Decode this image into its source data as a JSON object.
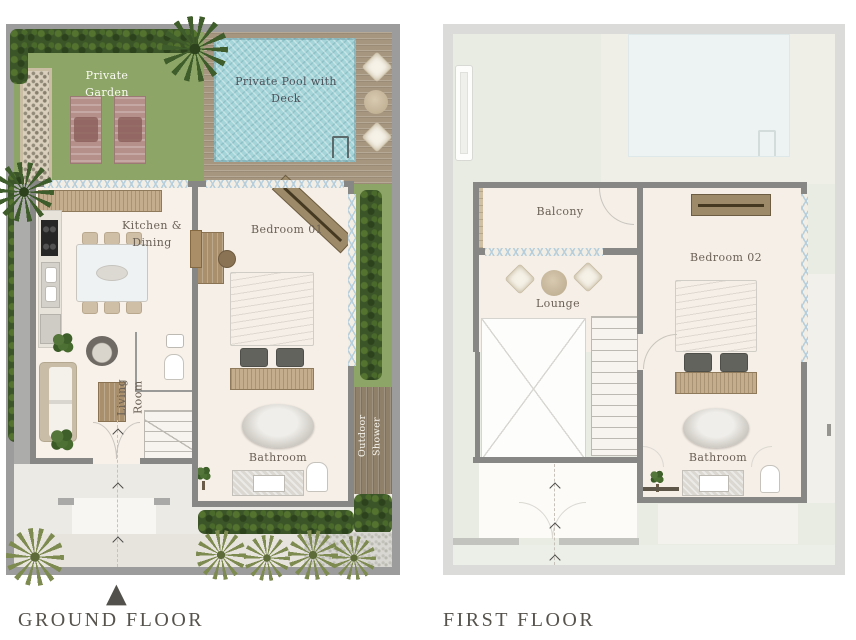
{
  "ground_floor": {
    "title": "GROUND FLOOR",
    "labels": {
      "private_garden": "Private Garden",
      "private_pool": "Private Pool with Deck",
      "kitchen_dining": "Kitchen & Dining",
      "bedroom_01": "Bedroom 01",
      "living_room": "Living Room",
      "bathroom": "Bathroom",
      "outdoor_shower": "Outdoor Shower"
    }
  },
  "first_floor": {
    "title": "FIRST FLOOR",
    "labels": {
      "balcony": "Balcony",
      "lounge": "Lounge",
      "bedroom_02": "Bedroom 02",
      "bathroom": "Bathroom"
    }
  },
  "icons": {
    "entrance_marker": "▲"
  },
  "colors": {
    "garden_green": "#8da667",
    "pool_blue": "#a5d5d9",
    "deck_wood": "#a6967f",
    "interior_cream": "#f6efe7",
    "wall_gray": "#878785",
    "hedge_green": "#3c5528",
    "ground_frame_gray": "#9c9c9c",
    "first_frame_gray": "#dbdbd9",
    "first_background": "#e9ece3",
    "label_brown": "#6b6156",
    "title_gray": "#56534d"
  }
}
